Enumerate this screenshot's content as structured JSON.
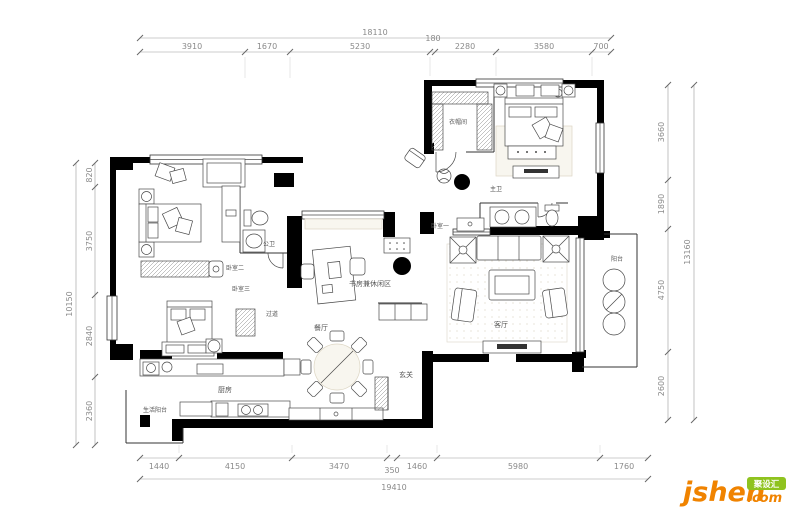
{
  "canvas": {
    "width": 790,
    "height": 507,
    "background": "#ffffff"
  },
  "dimensions": {
    "top": {
      "total": "18110",
      "segments": [
        "3910",
        "1670",
        "5230",
        "180",
        "2280",
        "3580",
        "700"
      ]
    },
    "bottom": {
      "total": "19410",
      "segments": [
        "1440",
        "4150",
        "3470",
        "350",
        "1460",
        "5980",
        "1760"
      ]
    },
    "left": {
      "total": "10150",
      "segments": [
        "820",
        "3750",
        "2840",
        "2360"
      ]
    },
    "right": {
      "total": "13160",
      "segments": [
        "3660",
        "1890",
        "4750",
        "2600"
      ]
    }
  },
  "rooms": {
    "bedroom1": "卧室一",
    "bedroom2": "卧室二",
    "bedroom3": "卧室三",
    "master_bath": "主卫",
    "guest_bath": "公卫",
    "cloakroom": "衣帽间",
    "living": "客厅",
    "dining": "餐厅",
    "kitchen": "厨房",
    "study": "书房兼休闲区",
    "hallway": "过道",
    "entry": "玄关",
    "balcony": "阳台",
    "service_balcony": "生活阳台"
  },
  "watermark": {
    "brand": "jsheh",
    "suffix": ".com",
    "badge": "聚设汇"
  },
  "colors": {
    "wall": "#000000",
    "dim_text": "#8a8a8a",
    "logo_orange": "#f08300",
    "logo_green": "#8fc31f"
  }
}
